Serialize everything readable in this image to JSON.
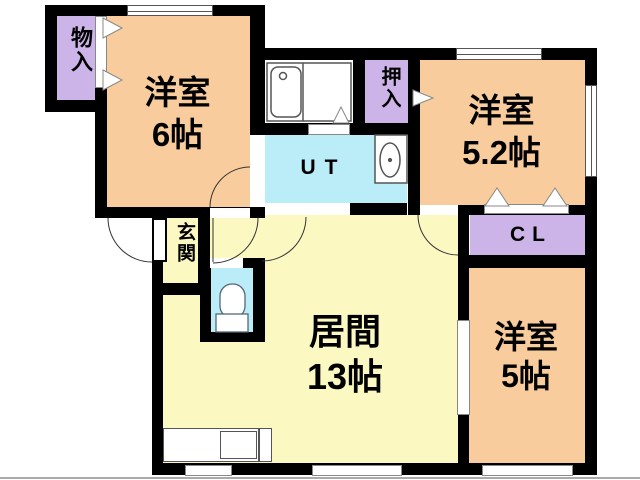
{
  "plan_title": "apartment-floor-plan",
  "rooms": {
    "storage": {
      "label": "物入"
    },
    "western6": {
      "name": "洋室",
      "size": "6帖"
    },
    "oshiire": {
      "label": "押入"
    },
    "utility": {
      "label": "UT"
    },
    "western52": {
      "name": "洋室",
      "size": "5.2帖"
    },
    "closet": {
      "label": "CL"
    },
    "entrance": {
      "label": "玄関"
    },
    "living": {
      "name": "居間",
      "size": "13帖"
    },
    "western5": {
      "name": "洋室",
      "size": "5帖"
    }
  },
  "fixtures": [
    "bathtub",
    "washbasin",
    "toilet",
    "kitchen-sink",
    "entry-door",
    "door-swing-arcs",
    "sliding-door-triangles",
    "windows"
  ],
  "colors": {
    "room_orange": "#F8CC9C",
    "closet_purple": "#CDB4E8",
    "wet_cyan": "#BBEDF8",
    "living_yellow": "#FBF8C2",
    "wall_black": "#000000",
    "outline_gray": "#555555"
  }
}
